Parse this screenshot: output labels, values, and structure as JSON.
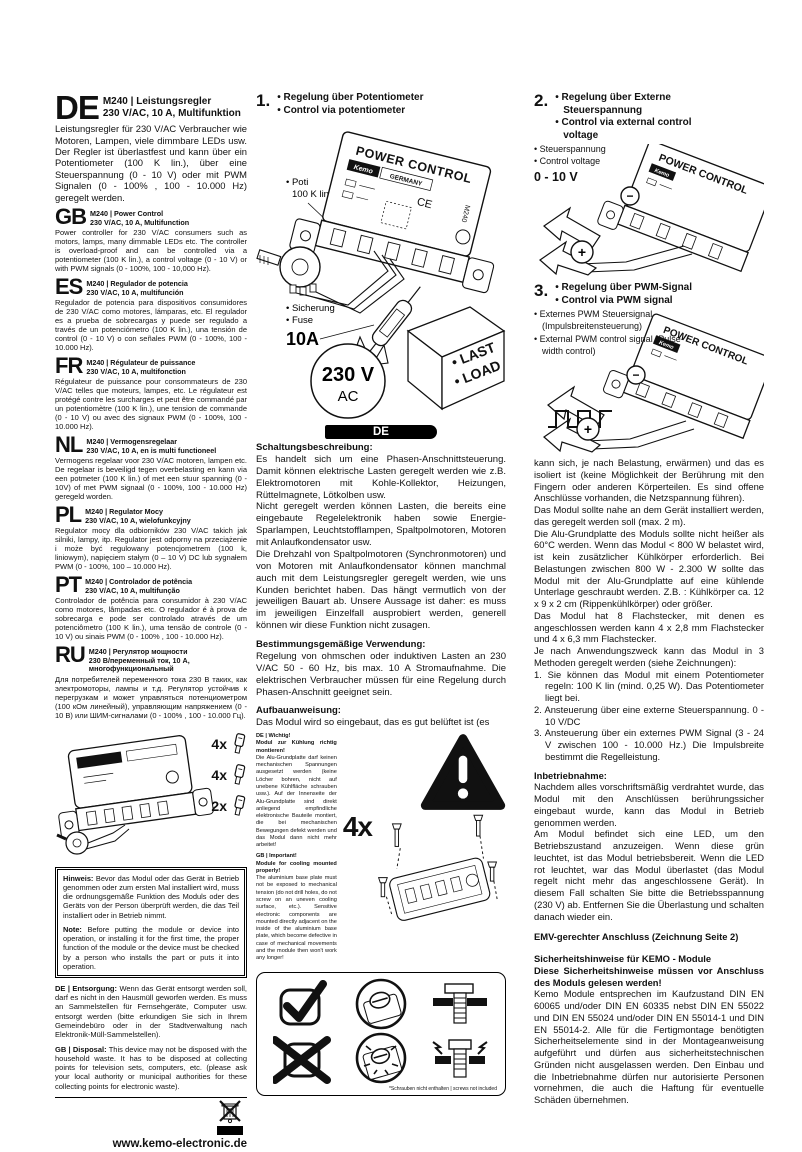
{
  "page": {
    "website": "www.kemo-electronic.de",
    "ce_label": "CE",
    "brand": {
      "name": "Kemo",
      "sub": "Electronic",
      "page_no": "1/4"
    },
    "barcode_digits": "4 024028 032405",
    "footer": "P / Module / M240 / Beschreibung / 08003DI / Karton 1 / Einl. Ver. 001"
  },
  "languages": [
    {
      "code": "DE",
      "title1": "M240 | Leistungsregler",
      "title2": "230 V/AC, 10 A, Multifunktion",
      "body": "Leistungsregler für 230 V/AC Verbraucher wie Motoren, Lampen, viele dimmbare LEDs usw. Der Regler ist überlastfest und kann über ein Potentiometer (100 K lin.), über eine Steuerspannung (0 - 10 V) oder mit PWM Signalen (0 - 100% , 100 - 10.000 Hz) geregelt werden."
    },
    {
      "code": "GB",
      "title1": "M240 | Power Control",
      "title2": "230 V/AC, 10 A, Multifunction",
      "body": "Power controller for 230 V/AC consumers such as motors, lamps, many dimmable LEDs etc. The controller is overload-proof and can be controlled via a potentiometer (100 K lin.), a control voltage (0 - 10 V) or with PWM signals (0 - 100%, 100 - 10,000 Hz)."
    },
    {
      "code": "ES",
      "title1": "M240 | Regulador de potencia",
      "title2": "230 V/AC, 10 A, multifunción",
      "body": "Regulador de potencia para dispositivos consumidores de 230 V/AC como motores, lámparas, etc. El regulador es a prueba de sobrecargas y puede ser regulado a través de un potenciómetro (100 K lin.), una tensión de control (0 - 10 V) o con señales PWM (0 - 100%, 100 - 10.000 Hz).",
      "note": ""
    },
    {
      "code": "FR",
      "title1": "M240  | Régulateur de puissance",
      "title2": "230 V/AC, 10 A, multifonction",
      "body": "Régulateur de puissance pour consommateurs de 230 V/AC telles que moteurs, lampes, etc. Le régulateur est protégé contre les surcharges et peut être commandé par un potentiomètre (100 K lin.), une tension de commande (0 - 10 V) ou avec des signaux PWM (0 - 100%, 100 - 10.000 Hz)."
    },
    {
      "code": "NL",
      "title1": "M240 | Vermogensregelaar",
      "title2": "230 V/AC, 10 A, en is multi functioneel",
      "body": "Vermogens regelaar voor 230 V/AC motoren, lampen etc. De regelaar is beveiligd tegen overbelasting en kann via een potmeter (100 K lin.) of met een stuur spanning (0 - 10V) of met PWM signaal (0 - 100%, 100 - 10.000 Hz) geregeld worden."
    },
    {
      "code": "PL",
      "title1": "M240 | Regulator Mocy",
      "title2": "230 V/AC, 10 A, wielofunkcyjny",
      "body": "Regulator mocy dla odbiorników 230 V/AC takich jak silniki, lampy, itp. Regulator jest odporny na przeciążenie i może być regulowany potencjometrem (100 k, liniowym), napięciem stałym (0 – 10 V) DC lub sygnałem PWM (0 - 100%, 100 – 10.000 Hz)."
    },
    {
      "code": "PT",
      "title1": "M240 | Controlador de potência",
      "title2": "230 V/AC, 10 A, multifunção",
      "body": "Controlador de potência para consumidor à 230 V/AC como motores, lâmpadas etc. O regulador é à prova de sobrecarga e pode ser controlado através de um potenciômetro (100 K lin.), uma tensão de controle (0 - 10 V) ou sinais PWM (0 - 100% , 100 - 10.000 Hz)."
    },
    {
      "code": "RU",
      "title1": "M240 | Регулятор мощности",
      "title2": "230 В/переменный ток, 10 А, многофункциональный",
      "body": "Для потребителей переменного тока 230 В таких, как электромоторы, лампы и т.д. Регулятор устойчив к перегрузкам и может управляться потенциометром (100 кОм линейный), управляющим напряжением (0 - 10 В) или ШИМ-сигналами (0 - 100% , 100 - 10.000 Гц)."
    }
  ],
  "parts": {
    "qty": [
      "4x",
      "4x",
      "2x"
    ]
  },
  "notice": {
    "de_label": "Hinweis:",
    "de_text": "Bevor das Modul oder das Gerät in Betrieb genommen oder zum ersten Mal installiert wird, muss die ordnungsgemäße Funktion des Moduls oder des Geräts von der Person überprüft werden, die das Teil installiert oder in Betrieb nimmt.",
    "en_label": "Note:",
    "en_text": "Before putting the module or device into operation, or installing it for the first time, the proper function of the module or the device must be checked by a person who installs the part or puts it into operation."
  },
  "disposal": {
    "de_label": "DE | Entsorgung:",
    "de_text": "Wenn das Gerät entsorgt werden soll, darf es nicht in den Hausmüll geworfen werden. Es muss an Sammelstellen für Fernsehgeräte, Computer usw. entsorgt werden (bitte erkundigen Sie sich in Ihrem Gemeindebüro oder in der Stadtverwaltung nach Elektronik-Müll-Sammelstellen).",
    "gb_label": "GB | Disposal:",
    "gb_text": "This device may not be disposed with the household waste. It has to be disposed at collecting points for television sets, computers, etc. (please ask your local authority or municipal authorities for these collecting points for electronic waste)."
  },
  "fig1": {
    "num": "1.",
    "bullets": [
      "• Regelung über Potentiometer",
      "• Control via potentiometer"
    ],
    "poti_label": "• Poti",
    "poti_value": "100 K lin.",
    "fuse_label_de": "• Sicherung",
    "fuse_label_en": "• Fuse",
    "fuse_value": "10A",
    "voltage": "230 V",
    "voltage_unit": "AC",
    "load_lines": [
      "• LAST",
      "• LOAD"
    ],
    "device": {
      "title": "POWER CONTROL",
      "brand": "Kemo",
      "country": "GERMANY",
      "model": "M240",
      "ce": "CE"
    }
  },
  "fig2": {
    "num": "2.",
    "bullets": [
      "• Regelung über Externe Steuerspannung",
      "• Control via external control voltage"
    ],
    "labels": [
      "• Steuerspannung",
      "• Control voltage"
    ],
    "value": "0 - 10 V",
    "minus": "−",
    "plus": "+"
  },
  "fig3": {
    "num": "3.",
    "bullets": [
      "• Regelung über PWM-Signal",
      "• Control via PWM signal"
    ],
    "labels": [
      "• Externes PWM Steuersignal (Impulsbreitensteuerung)",
      "• External PWM control signal (Pulse-width control)"
    ],
    "minus": "−",
    "plus": "+"
  },
  "mid": {
    "banner": "DE",
    "circuit_heading": "Schaltungsbeschreibung:",
    "circuit_paras": [
      "Es handelt sich um eine Phasen-Anschnittsteuerung. Damit können elektrische Lasten geregelt werden wie z.B. Elektromotoren mit Kohle-Kollektor, Heizungen, Rüttelmagnete, Lötkolben usw.",
      "Nicht geregelt werden können Lasten, die bereits eine eingebaute Regelelektronik haben sowie Energie-Sparlampen, Leuchtstofflampen, Spaltpolmotoren, Motoren mit Anlaufkondensator usw.",
      "Die Drehzahl von Spaltpolmotoren (Synchronmotoren) und von Motoren mit Anlaufkondensator können manchmal auch mit dem Leistungsregler geregelt werden, wie uns Kunden berichtet haben. Das hängt vermutlich von der jeweiligen Bauart ab. Unsere Aussage ist daher: es muss im jeweiligen Einzelfall ausprobiert werden, generell können wir diese Funktion nicht zusagen."
    ],
    "use_heading": "Bestimmungsgemäßige Verwendung:",
    "use_paras": [
      "Regelung von ohmschen oder induktiven Lasten an 230 V/AC  50 - 60 Hz, bis max. 10 A Stromaufnahme. Die elektrischen Verbraucher müssen für eine Regelung durch Phasen-Anschnitt geeignet sein."
    ],
    "assembly_heading": "Aufbauanweisung:",
    "assembly_paras": [
      "Das Modul wird so eingebaut, das es gut belüftet ist (es"
    ]
  },
  "mount": {
    "qty": "4x",
    "de_label": "DE | Wichtig!",
    "de_bold": "Modul zur Kühlung richtig montieren!",
    "de_text": "Die Alu-Grundplatte darf keinen mechanischen Spannungen ausgesetzt werden (keine Löcher bohren, nicht auf unebene Kühlfläche schrauben usw.). Auf der Innenseite der Alu-Grundplatte sind direkt anliegend empfindliche elektronische Bauteile montiert, die bei mechanischen Bewegungen defekt werden und das Modul dann nicht mehr arbeitet!",
    "gb_label": "GB | Important!",
    "gb_bold": "Module for cooling mounted properly!",
    "gb_text": "The aluminium base plate must not be exposed to mechanical tension (do not drill holes, do not screw on an uneven cooling surface, etc.). Sensitive electronic components are mounted directly adjacent on the inside of the aluminium base plate, which become defective in case of mechanical movements and the module then won't work any longer!",
    "footnote": "*Schrauben nicht enthalten | screws not included"
  },
  "right": {
    "paras": [
      "kann sich, je nach Belastung, erwärmen) und das es isoliert ist (keine Möglichkeit der Berührung mit den Fingern oder anderen Körperteilen. Es sind offene Anschlüsse vorhanden, die Netzspannung führen).",
      "Das Modul sollte nahe an dem Gerät installiert werden, das geregelt werden soll (max. 2 m).",
      "Die Alu-Grundplatte des Moduls sollte nicht heißer als 60°C werden. Wenn das Modul < 800 W belastet wird, ist kein zusätzlicher Kühlkörper erforderlich. Bei Belastungen zwischen 800 W - 2.300 W sollte das Modul mit der Alu-Grundplatte auf eine kühlende Unterlage geschraubt werden. Z.B. : Kühlkörper ca. 12 x 9 x 2 cm (Rippenkühlkörper) oder größer.",
      "Das Modul hat 8 Flachstecker, mit denen es angeschlossen werden kann  4 x 2,8 mm Flachstecker und 4 x 6,3 mm Flachstecker.",
      "Je nach Anwendungszweck kann das Modul in 3 Methoden geregelt werden (siehe Zeichnungen):"
    ],
    "list": [
      "1. Sie können das Modul mit einem Potentiometer regeln: 100 K lin (mind. 0,25 W). Das Potentiometer liegt bei.",
      "2. Ansteuerung über eine externe Steuerspannung. 0 - 10 V/DC",
      "3. Ansteuerung über ein externes PWM Signal (3 - 24 V zwischen 100 - 10.000 Hz.) Die Impulsbreite bestimmt die Regelleistung."
    ],
    "startup_heading": "Inbetriebnahme:",
    "startup_paras": [
      "Nachdem alles vorschriftsmäßig verdrahtet wurde, das Modul mit den Anschlüssen berührungssicher eingebaut wurde, kann das Modul in Betrieb genommen werden.",
      "Am Modul befindet sich eine LED, um den Betriebszustand anzuzeigen. Wenn diese grün leuchtet, ist das Modul betriebsbereit. Wenn die LED rot leuchtet, war das Modul überlastet  (das Modul regelt nicht mehr das angeschlossene Gerät). In diesem Fall schalten Sie bitte die Betriebsspannung (230 V) ab. Entfernen Sie die Überlastung und schalten danach wieder ein."
    ],
    "emv": "EMV-gerechter Anschluss (Zeichnung Seite 2)",
    "safety_heading": "Sicherheitshinweise für KEMO - Module",
    "safety_sub": "Diese Sicherheitshinweise müssen vor Anschluss des Moduls gelesen werden!",
    "safety_body": "Kemo Module entsprechen im Kaufzustand DIN EN 60065 und/oder DIN EN 60335 nebst DIN EN 55022 und DIN EN 55024 und/oder DIN EN 55014-1 und DIN EN 55014-2. Alle für die Fertigmontage benötigten Sicherheitselemente sind in der Montageanweisung aufgeführt und dürfen aus sicherheitstechnischen Gründen nicht ausgelassen werden. Den Einbau und die Inbetriebnahme dürfen nur autorisierte Personen vornehmen, die auch die Haftung für eventuelle Schäden übernehmen."
  }
}
